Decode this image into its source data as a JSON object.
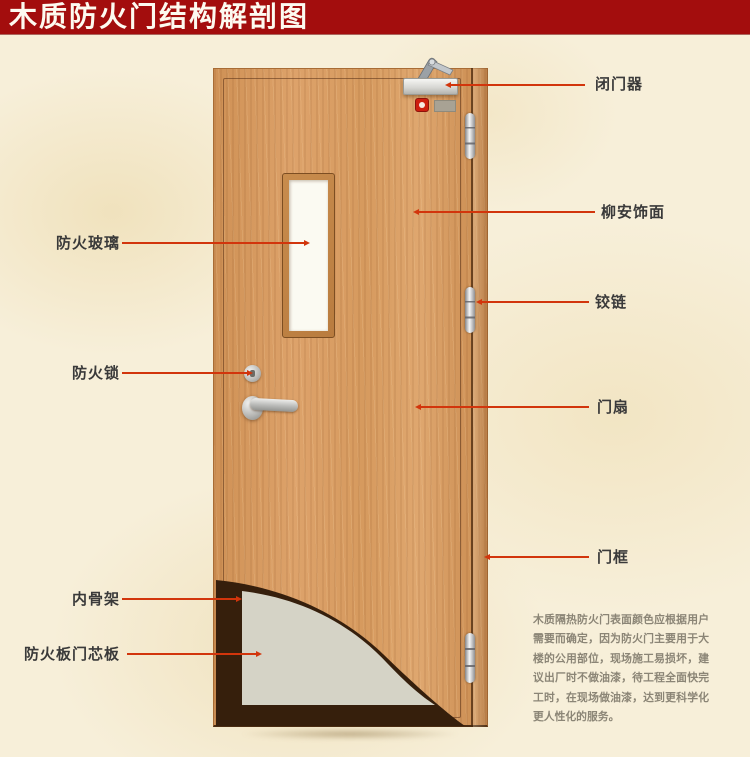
{
  "title": "木质防火门结构解剖图",
  "colors": {
    "banner_red": "#a30d0d",
    "leader_line_red": "#d2350c",
    "label_text": "#3a3a3a",
    "background_cream": "#f7efd9",
    "door_wood": "#d69a5e",
    "glass_white": "#fbfaf2",
    "core_gray": "#d5d3c6",
    "skeleton_dark": "#361f0c"
  },
  "labels": {
    "left": [
      {
        "id": "fire-glass",
        "text": "防火玻璃"
      },
      {
        "id": "fire-lock",
        "text": "防火锁"
      },
      {
        "id": "inner-skeleton",
        "text": "内骨架"
      },
      {
        "id": "core-board",
        "text": "防火板门芯板"
      }
    ],
    "right": [
      {
        "id": "door-closer",
        "text": "闭门器"
      },
      {
        "id": "veneer",
        "text": "柳安饰面"
      },
      {
        "id": "hinge",
        "text": "铰链"
      },
      {
        "id": "door-leaf",
        "text": "门扇"
      },
      {
        "id": "door-frame",
        "text": "门框"
      }
    ]
  },
  "description": "木质隔热防火门表面颜色应根据用户需要而确定，因为防火门主要用于大楼的公用部位，现场施工易损坏，建议出厂时不做油漆，待工程全面快完工时，在现场做油漆，达到更科学化更人性化的服务。"
}
